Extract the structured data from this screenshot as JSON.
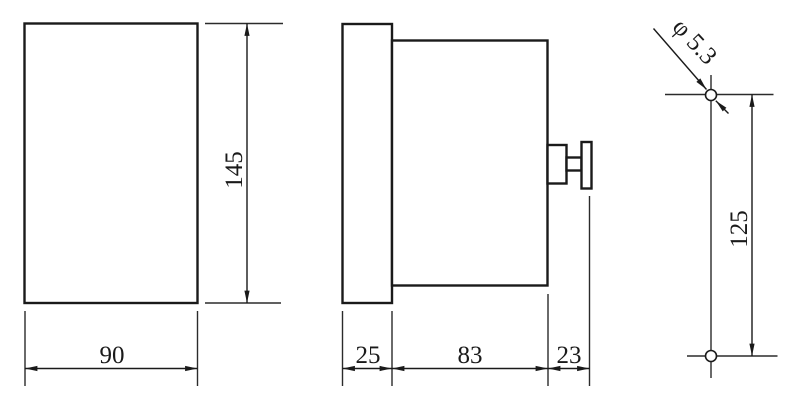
{
  "drawing": {
    "front_view": {
      "width_label": "90",
      "height_label": "145"
    },
    "side_view": {
      "bezel_depth_label": "25",
      "body_depth_label": "83",
      "stud_depth_label": "23"
    },
    "mounting_view": {
      "hole_diameter_label": "φ 5.3",
      "hole_spacing_label": "125"
    }
  },
  "colors": {
    "line": "#1a1a1a",
    "background": "#ffffff"
  }
}
